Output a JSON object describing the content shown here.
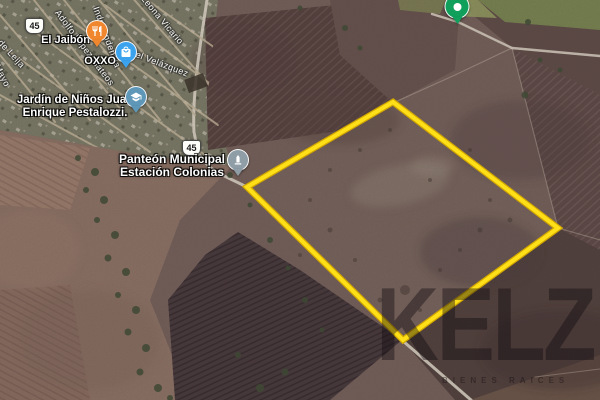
{
  "map": {
    "parcel": {
      "points": "393,102 558,228 403,340 247,187",
      "stroke_color": "#FFE018"
    },
    "highway_shields": [
      {
        "number": "45"
      },
      {
        "number": "45"
      }
    ],
    "streets": [
      {
        "label": "Adolfo López Mateos"
      },
      {
        "label": "Independencia"
      },
      {
        "label": "Leona Vicario"
      },
      {
        "label": "del Velázquez"
      },
      {
        "label": "o de Leija"
      },
      {
        "label": "Mayo"
      }
    ],
    "pois": [
      {
        "name": "El Jaibón",
        "category": "restaurant",
        "pin_color": "#F0862D"
      },
      {
        "name": "OXXO",
        "category": "convenience store",
        "pin_color": "#3BA3EE"
      },
      {
        "name": "Jardín de Niños Juan Enrique Pestalozzi.",
        "category": "school",
        "pin_color": "#5E97B8"
      },
      {
        "name": "Panteón Municipal Estación Colonias",
        "category": "cemetery",
        "pin_color": "#8E9DA6"
      },
      {
        "name": "",
        "category": "place marker",
        "pin_color": "#11A05C"
      }
    ],
    "watermark": {
      "brand": "KELZ",
      "subtext": "BIENES RAICES"
    }
  }
}
